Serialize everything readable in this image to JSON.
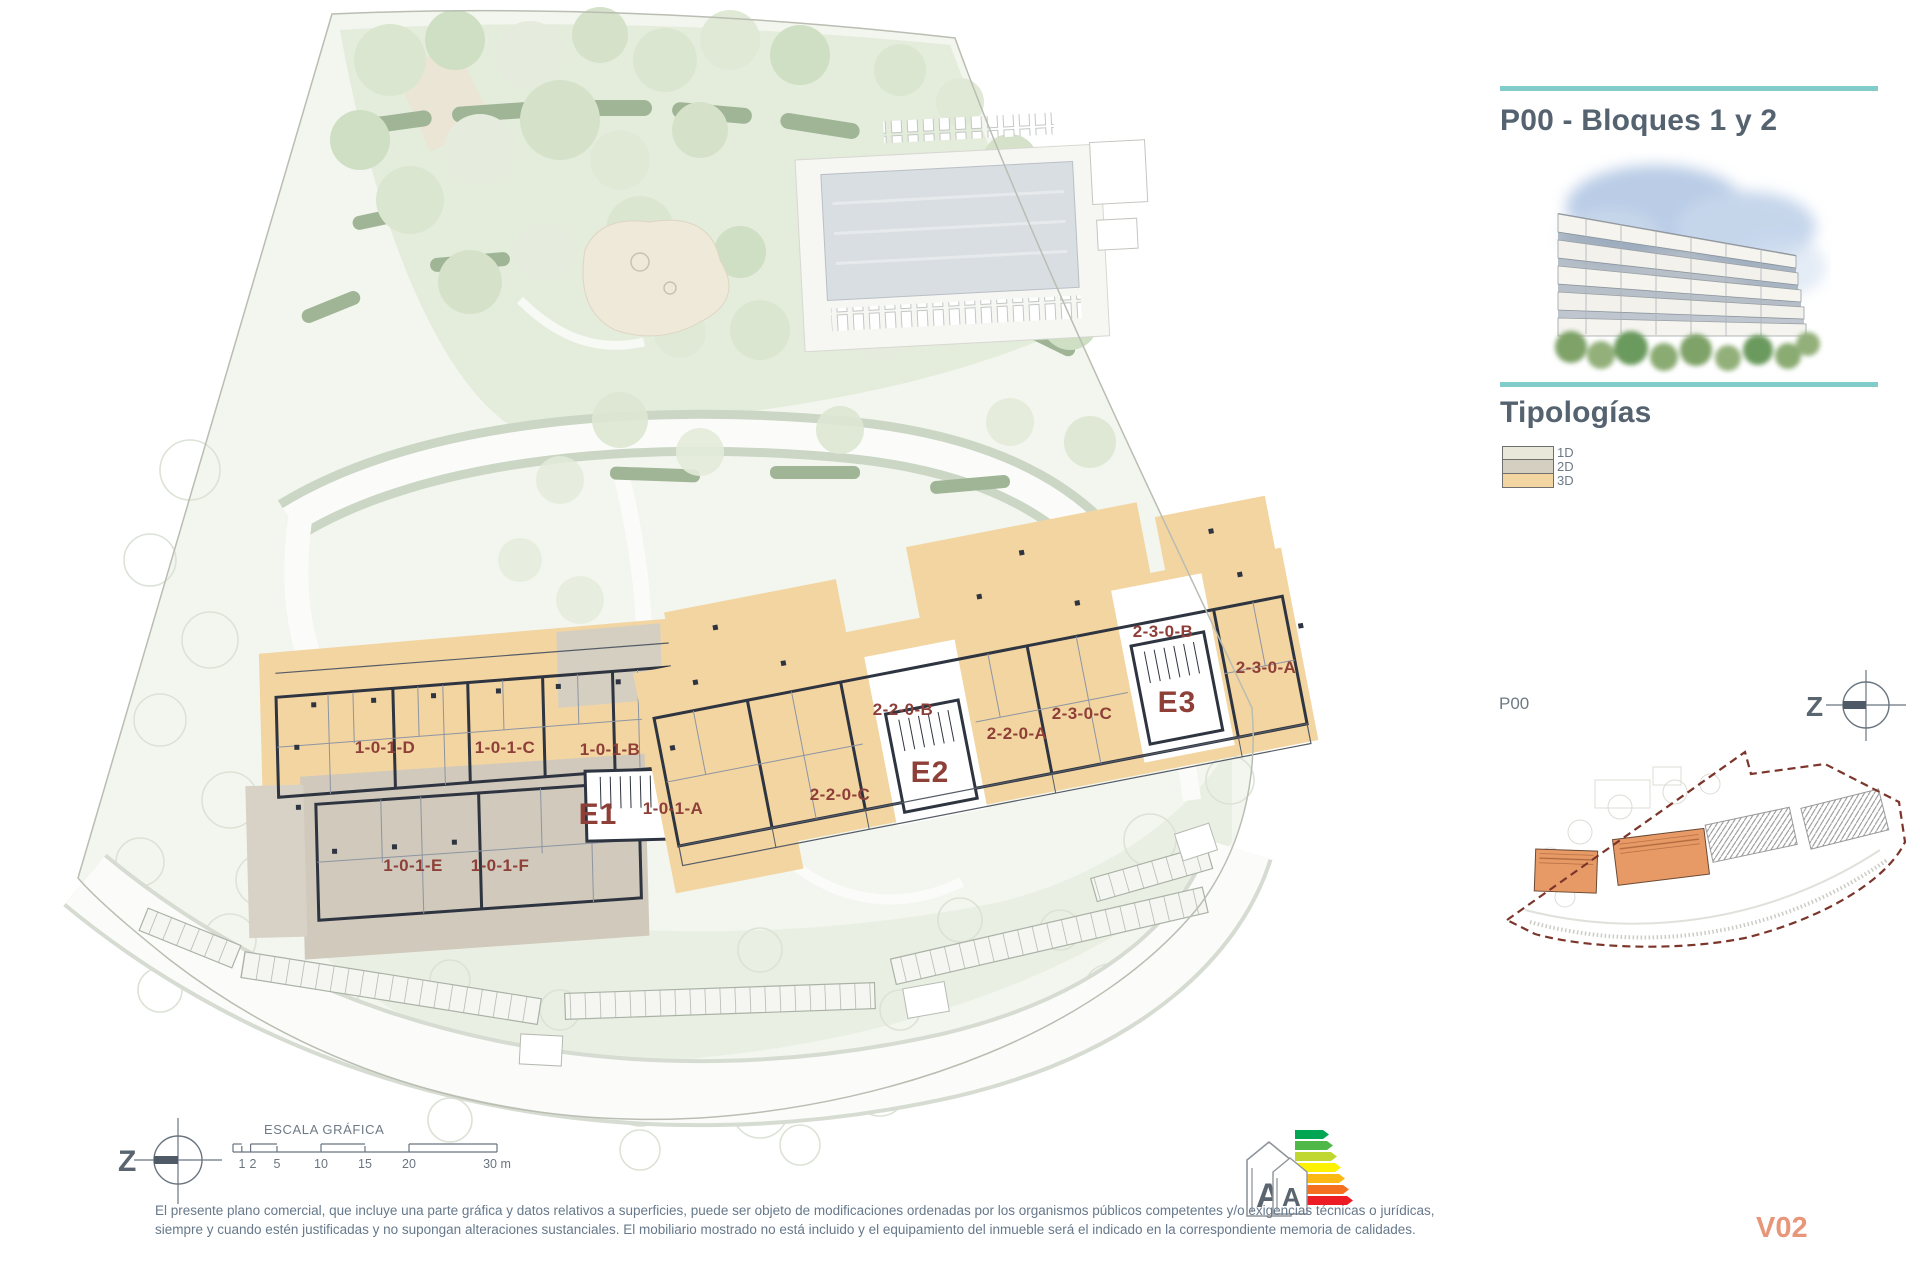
{
  "header": {
    "title": "P00 - Bloques 1 y 2"
  },
  "section": {
    "title": "Tipologías"
  },
  "legend": {
    "items": [
      {
        "label": "1D",
        "color": "#e9e6da"
      },
      {
        "label": "2D",
        "color": "#d5cfc2"
      },
      {
        "label": "3D",
        "color": "#f3d5a2"
      }
    ]
  },
  "minimap": {
    "label": "P00"
  },
  "compass": {
    "label": "Z"
  },
  "plan": {
    "blocks": {
      "e1": "E1",
      "e2": "E2",
      "e3": "E3"
    },
    "units": {
      "u101d": "1-0-1-D",
      "u101c": "1-0-1-C",
      "u101b": "1-0-1-B",
      "u101a": "1-0-1-A",
      "u101e": "1-0-1-E",
      "u101f": "1-0-1-F",
      "u220c": "2-2-0-C",
      "u220b": "2-2-0-B",
      "u220a": "2-2-0-A",
      "u230c": "2-3-0-C",
      "u230b": "2-3-0-B",
      "u230a": "2-3-0-A"
    }
  },
  "scalebar": {
    "title": "ESCALA GRÁFICA",
    "ticks": [
      "1",
      "2",
      "5",
      "10",
      "15",
      "20",
      "30 m"
    ]
  },
  "energy_label": {
    "letters": [
      "A",
      "A"
    ],
    "scale_colors": [
      "#00a651",
      "#50b848",
      "#bfd730",
      "#fff200",
      "#fdb913",
      "#f37021",
      "#ed1c24"
    ]
  },
  "disclaimer": "El presente plano comercial, que incluye una parte gráfica y datos relativos a superficies, puede ser objeto de modificaciones ordenadas por los organismos públicos competentes y/o exigencias técnicas o jurídicas, siempre y cuando estén justificadas y no supongan alteraciones sustanciales. El mobiliario mostrado no está incluido y el equipamiento del inmueble será el indicado en la correspondiente memoria de calidades.",
  "version": "V02",
  "colors": {
    "accent_teal": "#82cdc9",
    "unit_label": "#8e3f38",
    "heading": "#55626f",
    "version": "#e8967a",
    "typology_1d": "#e9e6da",
    "typology_2d": "#d5cfc2",
    "typology_3d": "#f3d5a2",
    "minimap_boundary": "#7c352b"
  }
}
